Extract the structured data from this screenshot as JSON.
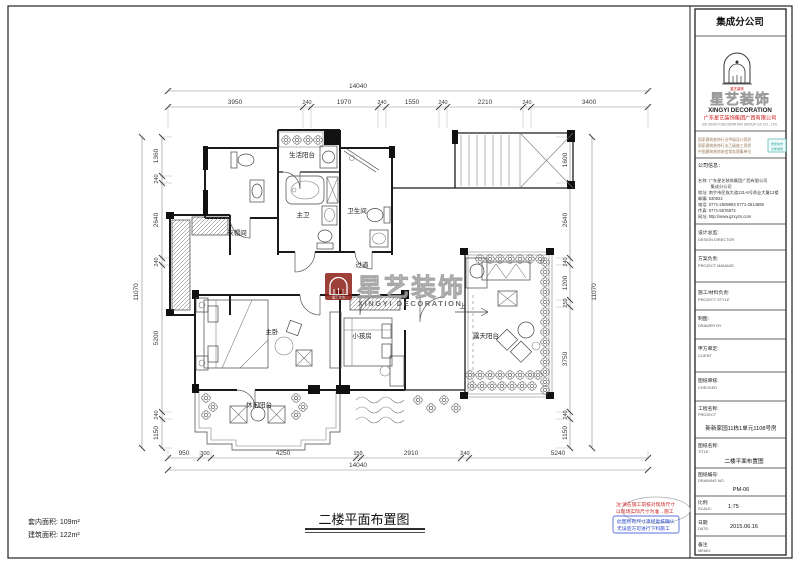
{
  "sheet": {
    "footer_title": "二楼平面布置图",
    "area_inner": "套内面积: 109m²",
    "area_build": "建筑面积: 122m²"
  },
  "rooms": {
    "service_balcony": "生活阳台",
    "master_bath": "主卫",
    "bath": "卫生间",
    "cloakroom": "衣帽间",
    "hall": "过道",
    "master_bed": "主卧",
    "kids": "小孩房",
    "leisure_balcony": "休闲阳台",
    "terrace": "露天阳台",
    "up": "上"
  },
  "watermark": {
    "name": "星艺装饰",
    "en": "XINGYI DECORATION"
  },
  "dims": {
    "top": {
      "overall": "14040",
      "segs": [
        "3950",
        "240",
        "1970",
        "240",
        "1550",
        "240",
        "2210",
        "240",
        "3400"
      ]
    },
    "bottom": {
      "overall": "14040",
      "segs": [
        "950",
        "300",
        "4250",
        "150",
        "2910",
        "240",
        "5240"
      ]
    },
    "left": {
      "overall": "11070",
      "segs": [
        "1360",
        "240",
        "2640",
        "240",
        "5200",
        "240",
        "1150"
      ]
    },
    "right": {
      "overall": "11070",
      "segs": [
        "1600",
        "2640",
        "240",
        "1200",
        "250",
        "3750",
        "240",
        "1150"
      ]
    }
  },
  "notes": {
    "r1": "注:请在施工前核对现场尺寸",
    "r2": "以现场实际尺寸为准→施工",
    "b1": "此图所有尺寸须经复核确认",
    "b2": "无误后方可进行下料施工"
  },
  "titleblock": {
    "header": "集成分公司",
    "crest_caption": "星艺装饰",
    "brand_name": "星艺装饰",
    "brand_en": "XINGYI DECORATION",
    "company_cn": "广东星艺装饰集团广西有限公司",
    "company_en": "GD XINGYI DECORATION GROUP GX CO., LTD.",
    "honors": [
      "国家建筑装饰行业甲级设计资质",
      "国家建筑装饰行业乙级施工资质",
      "中国建筑装饰协会常务理事单位"
    ],
    "stamp1": "质量信誉",
    "stamp2": "双重保障",
    "info_header": "公司信息：",
    "info": [
      "名称: 广东星艺装饰集团广西有限公司",
      "　　　集成分公司",
      "地址: 南宁市民族大道131-6号承业大厦12楼",
      "邮编: 530022",
      "电话: 0771-2609993  0771-2614659",
      "传真: 0771-5576672",
      "网址: http://www.gzxyzs.com"
    ],
    "fields": [
      {
        "cn": "设计总监:",
        "en": "DESIGN DIRECTOR"
      },
      {
        "cn": "方案负责:",
        "en": "PROJECT MANAGE"
      },
      {
        "cn": "施工/材料负责:",
        "en": "PROJECT STYLE"
      },
      {
        "cn": "制图:",
        "en": "DRAWER BY"
      },
      {
        "cn": "甲方审定:",
        "en": "CLIENT"
      },
      {
        "cn": "图纸审核:",
        "en": "CHECKED"
      }
    ],
    "project": {
      "cn": "工程名称:",
      "en": "PROJECT",
      "value": "新新家园11栋1单元1108号房"
    },
    "drawing": {
      "cn": "图纸名称:",
      "en": "TITLE",
      "value": "二楼平面布置图"
    },
    "number": {
      "cn": "图纸编号:",
      "en": "DRAWING NO.",
      "value": "PM-06"
    },
    "scale": {
      "cn": "比例",
      "en": "SCALE:",
      "value": "1:75"
    },
    "date": {
      "cn": "日期",
      "en": "DATE:",
      "value": "2015.06.16"
    },
    "memo": {
      "cn": "备注",
      "en": "MEMO:"
    }
  }
}
